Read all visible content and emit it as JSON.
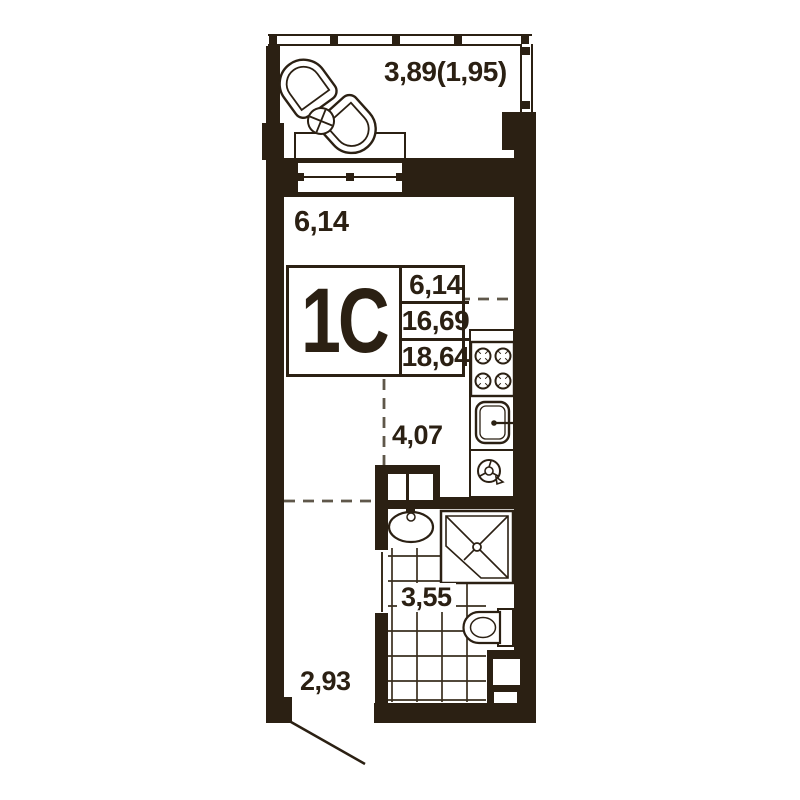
{
  "unit": {
    "type_label": "1С",
    "area_rows": [
      "6,14",
      "16,69",
      "18,64"
    ]
  },
  "room_labels": {
    "balcony": "3,89(1,95)",
    "living": "6,14",
    "kitchen_zone": "4,07",
    "bathroom": "3,55",
    "hall": "2,93"
  },
  "colors": {
    "wall": "#2b2013",
    "dash_line": "#5f574a",
    "thin_line": "#3a2f1f",
    "background": "#ffffff"
  },
  "fixtures": {
    "balcony": [
      "armchair",
      "armchair",
      "coffee-table"
    ],
    "kitchen": [
      "stove",
      "kitchen-sink",
      "vent-fan"
    ],
    "bathroom": [
      "wash-basin",
      "shower-cabin",
      "toilet",
      "tile-floor"
    ],
    "other": [
      "window",
      "window-sill",
      "vent-shaft",
      "entry-door"
    ]
  }
}
